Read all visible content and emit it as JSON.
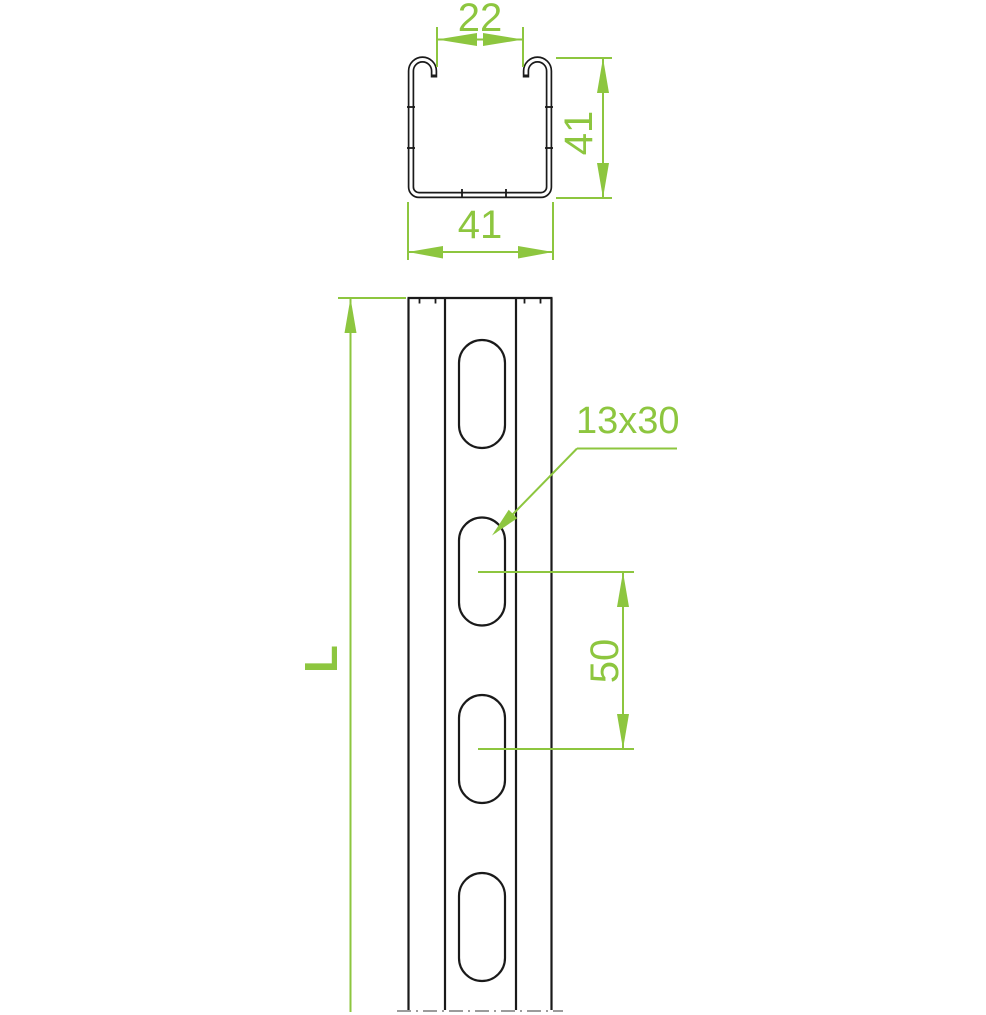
{
  "colors": {
    "accent": "#8DC63F",
    "line": "#1A1A1A",
    "break_line": "#9B9B9B",
    "background": "#FFFFFF"
  },
  "cross_section": {
    "opening_width": "22",
    "height": "41",
    "width": "41"
  },
  "front_view": {
    "length_label": "L",
    "slot_pitch": "50",
    "slot_size": "13x30",
    "visible_slots": 4
  }
}
